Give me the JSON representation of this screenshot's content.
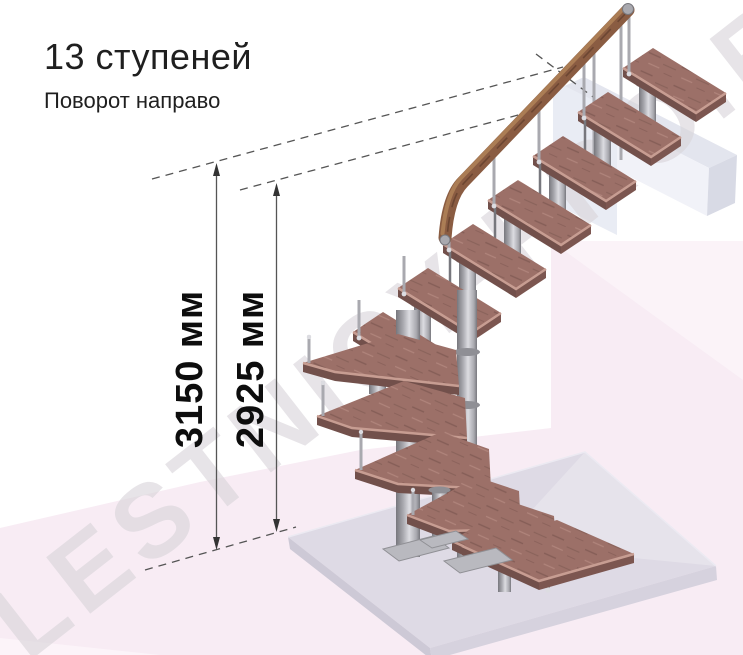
{
  "title": "13 ступеней",
  "subtitle": "Поворот направо",
  "dimensions": {
    "outer": "3150 мм",
    "inner": "2925 мм"
  },
  "watermark": "LESTNICY-PRO.RU",
  "colors": {
    "ink": "#1f1f1f",
    "dimline": "#555555",
    "watermark": "#d9d5da",
    "pink": "#f8ecf4",
    "pinklight": "#fcf4f9",
    "slabtop": "#dedae5",
    "slabfront": "#cdc9d6",
    "slabright": "#d6d2de",
    "beamtop": "#e3e5ee",
    "beamfront": "#f1f2f8",
    "beamend": "#d8dae5",
    "panel": "#e9ecf4",
    "wood": "#9c7068",
    "wooddark": "#7c5650",
    "woodside": "#72504b",
    "woodlight": "#c79d92",
    "railwood": "#8a5c42",
    "raildark": "#5f3d2c",
    "raillight": "#b08358",
    "metal": "#a9a9af",
    "metaldark": "#77777d",
    "metallight": "#dcdce1"
  }
}
